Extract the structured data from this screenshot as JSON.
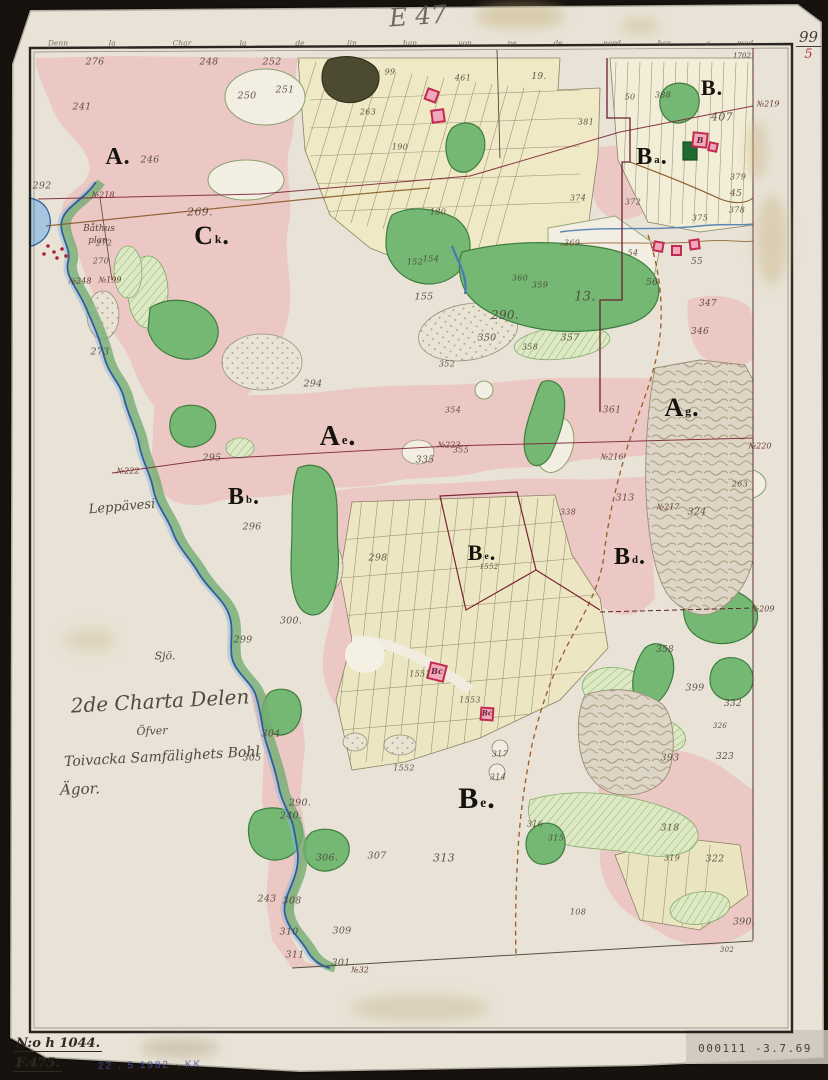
{
  "header": {
    "sheet_code": "E 47",
    "page_number_top": "99",
    "page_number_bottom": "5"
  },
  "archive": {
    "number": "N:o h 1044.",
    "code": "F.475.",
    "stamp_blue": "22 . 5 1982 · KK",
    "stamp_bottom_right": "000111  -3.7.69"
  },
  "margin_words": [
    {
      "t": "Denn",
      "x": 58
    },
    {
      "t": "Ja",
      "x": 112
    },
    {
      "t": "Char",
      "x": 182
    },
    {
      "t": "la",
      "x": 243
    },
    {
      "t": "de",
      "x": 300
    },
    {
      "t": "lin",
      "x": 352
    },
    {
      "t": "han",
      "x": 410
    },
    {
      "t": "von",
      "x": 465
    },
    {
      "t": "ne",
      "x": 512
    },
    {
      "t": "de",
      "x": 558
    },
    {
      "t": "nord",
      "x": 612
    },
    {
      "t": "har",
      "x": 664
    },
    {
      "t": "a",
      "x": 708
    },
    {
      "t": "med",
      "x": 745
    }
  ],
  "colors": {
    "paper": "#e8e3d6",
    "pink_wash": "#ebc8c3",
    "meadow_green": "#74b874",
    "field_yellow": "#efe9c6",
    "water_blue": "#2d5f9e",
    "boundary_red": "#7d2336",
    "marsh": "#ddd5c5",
    "building_red": "#c22a4e",
    "stamp_blue": "#4953ae"
  },
  "map": {
    "section_letters": [
      {
        "n": "section-a",
        "t": "A",
        "d": 1,
        "x": 118,
        "y": 157,
        "fs": 24
      },
      {
        "n": "section-ck",
        "t": "C",
        "s": "k",
        "d": 1,
        "x": 212,
        "y": 236,
        "fs": 26
      },
      {
        "n": "section-b",
        "t": "B",
        "d": 1,
        "x": 712,
        "y": 88,
        "fs": 22
      },
      {
        "n": "section-ba",
        "t": "B",
        "s": "a",
        "d": 1,
        "x": 652,
        "y": 157,
        "fs": 24
      },
      {
        "n": "section-ae-west",
        "t": "A",
        "s": "e",
        "d": 1,
        "x": 338,
        "y": 437,
        "fs": 28
      },
      {
        "n": "section-ag-east",
        "t": "A",
        "s": "g",
        "d": 1,
        "x": 682,
        "y": 408,
        "fs": 26
      },
      {
        "n": "section-bb",
        "t": "B",
        "s": "b",
        "d": 1,
        "x": 244,
        "y": 497,
        "fs": 24
      },
      {
        "n": "section-be-village",
        "t": "B",
        "s": "e",
        "d": 1,
        "x": 482,
        "y": 553,
        "fs": 22
      },
      {
        "n": "section-bd",
        "t": "B",
        "s": "d",
        "d": 1,
        "x": 630,
        "y": 557,
        "fs": 24
      },
      {
        "n": "section-be-south",
        "t": "B",
        "s": "e",
        "d": 1,
        "x": 477,
        "y": 799,
        "fs": 30
      }
    ],
    "parcel_numbers": [
      {
        "t": "276",
        "x": 95,
        "y": 62
      },
      {
        "t": "248",
        "x": 209,
        "y": 62
      },
      {
        "t": "252",
        "x": 272,
        "y": 62
      },
      {
        "t": "251",
        "x": 285,
        "y": 90
      },
      {
        "t": "250",
        "x": 247,
        "y": 96
      },
      {
        "t": "241",
        "x": 82,
        "y": 107
      },
      {
        "t": "246",
        "x": 150,
        "y": 160
      },
      {
        "t": "292",
        "x": 42,
        "y": 186
      },
      {
        "t": "269.",
        "x": 200,
        "y": 212,
        "fs": 11
      },
      {
        "t": "272",
        "x": 104,
        "y": 243,
        "fs": 8
      },
      {
        "t": "270",
        "x": 101,
        "y": 261,
        "fs": 8
      },
      {
        "t": "273",
        "x": 100,
        "y": 352
      },
      {
        "t": "295",
        "x": 212,
        "y": 458
      },
      {
        "t": "294",
        "x": 313,
        "y": 384
      },
      {
        "t": "296",
        "x": 252,
        "y": 527
      },
      {
        "t": "299",
        "x": 243,
        "y": 640
      },
      {
        "t": "300.",
        "x": 291,
        "y": 621
      },
      {
        "t": "304",
        "x": 271,
        "y": 734
      },
      {
        "t": "305",
        "x": 252,
        "y": 758
      },
      {
        "t": "290.",
        "x": 300,
        "y": 803
      },
      {
        "t": "240.",
        "x": 291,
        "y": 816
      },
      {
        "t": "243",
        "x": 267,
        "y": 899
      },
      {
        "t": "306.",
        "x": 327,
        "y": 858
      },
      {
        "t": "307",
        "x": 377,
        "y": 856
      },
      {
        "t": "308",
        "x": 292,
        "y": 901
      },
      {
        "t": "310",
        "x": 289,
        "y": 932
      },
      {
        "t": "309",
        "x": 342,
        "y": 931
      },
      {
        "t": "311",
        "x": 295,
        "y": 955
      },
      {
        "t": "301",
        "x": 341,
        "y": 963
      },
      {
        "t": "313",
        "x": 444,
        "y": 858,
        "fs": 11
      },
      {
        "t": "99",
        "x": 390,
        "y": 72,
        "fs": 8
      },
      {
        "t": "461",
        "x": 463,
        "y": 78,
        "fs": 8
      },
      {
        "t": "263",
        "x": 368,
        "y": 112,
        "fs": 8
      },
      {
        "t": "190",
        "x": 400,
        "y": 147,
        "fs": 8
      },
      {
        "t": "180",
        "x": 438,
        "y": 212,
        "fs": 8
      },
      {
        "t": "152",
        "x": 415,
        "y": 262,
        "fs": 8
      },
      {
        "t": "19.",
        "x": 539,
        "y": 77,
        "fs": 9
      },
      {
        "t": "50",
        "x": 630,
        "y": 97,
        "fs": 8
      },
      {
        "t": "388",
        "x": 663,
        "y": 95,
        "fs": 8
      },
      {
        "t": "381",
        "x": 586,
        "y": 122,
        "fs": 8
      },
      {
        "t": "407",
        "x": 722,
        "y": 117,
        "fs": 11
      },
      {
        "t": "379",
        "x": 738,
        "y": 177,
        "fs": 8
      },
      {
        "t": "45",
        "x": 736,
        "y": 194,
        "fs": 9
      },
      {
        "t": "378",
        "x": 737,
        "y": 210,
        "fs": 8
      },
      {
        "t": "374",
        "x": 578,
        "y": 198,
        "fs": 8
      },
      {
        "t": "372",
        "x": 633,
        "y": 202,
        "fs": 8
      },
      {
        "t": "369",
        "x": 572,
        "y": 243,
        "fs": 8
      },
      {
        "t": "375",
        "x": 700,
        "y": 218,
        "fs": 8
      },
      {
        "t": "54",
        "x": 633,
        "y": 253,
        "fs": 8
      },
      {
        "t": "55",
        "x": 697,
        "y": 262,
        "fs": 9
      },
      {
        "t": "56",
        "x": 652,
        "y": 283,
        "fs": 9
      },
      {
        "t": "347",
        "x": 708,
        "y": 304,
        "fs": 9
      },
      {
        "t": "346",
        "x": 700,
        "y": 332,
        "fs": 9
      },
      {
        "t": "154",
        "x": 431,
        "y": 259,
        "fs": 8
      },
      {
        "t": "155",
        "x": 424,
        "y": 297
      },
      {
        "t": "360",
        "x": 520,
        "y": 278,
        "fs": 8
      },
      {
        "t": "359",
        "x": 540,
        "y": 285,
        "fs": 8
      },
      {
        "t": "13.",
        "x": 585,
        "y": 297,
        "fs": 13
      },
      {
        "t": "290.",
        "x": 505,
        "y": 315,
        "fs": 12
      },
      {
        "t": "350",
        "x": 487,
        "y": 338
      },
      {
        "t": "357",
        "x": 570,
        "y": 338
      },
      {
        "t": "358",
        "x": 530,
        "y": 347,
        "fs": 8
      },
      {
        "t": "352",
        "x": 447,
        "y": 364,
        "fs": 8
      },
      {
        "t": "354",
        "x": 453,
        "y": 410,
        "fs": 8
      },
      {
        "t": "355",
        "x": 461,
        "y": 450,
        "fs": 8
      },
      {
        "t": "335",
        "x": 425,
        "y": 460
      },
      {
        "t": "361",
        "x": 612,
        "y": 410
      },
      {
        "t": "313",
        "x": 625,
        "y": 498
      },
      {
        "t": "324",
        "x": 697,
        "y": 512
      },
      {
        "t": "263",
        "x": 740,
        "y": 484,
        "fs": 8
      },
      {
        "t": "338",
        "x": 568,
        "y": 512,
        "fs": 8
      },
      {
        "t": "298",
        "x": 378,
        "y": 558
      },
      {
        "t": "1552",
        "x": 489,
        "y": 567,
        "fs": 7
      },
      {
        "t": "1551",
        "x": 420,
        "y": 674,
        "fs": 8
      },
      {
        "t": "1553",
        "x": 470,
        "y": 700,
        "fs": 8
      },
      {
        "t": "1552",
        "x": 404,
        "y": 768,
        "fs": 8
      },
      {
        "t": "317",
        "x": 500,
        "y": 754,
        "fs": 8
      },
      {
        "t": "314",
        "x": 498,
        "y": 777,
        "fs": 8
      },
      {
        "t": "358",
        "x": 665,
        "y": 650,
        "fs": 9
      },
      {
        "t": "399",
        "x": 695,
        "y": 688
      },
      {
        "t": "332",
        "x": 733,
        "y": 704,
        "fs": 9
      },
      {
        "t": "326",
        "x": 720,
        "y": 726,
        "fs": 7
      },
      {
        "t": "393",
        "x": 670,
        "y": 758
      },
      {
        "t": "323",
        "x": 725,
        "y": 757,
        "fs": 9
      },
      {
        "t": "316",
        "x": 535,
        "y": 824,
        "fs": 8
      },
      {
        "t": "315",
        "x": 556,
        "y": 838,
        "fs": 8
      },
      {
        "t": "318",
        "x": 670,
        "y": 828
      },
      {
        "t": "319",
        "x": 672,
        "y": 858,
        "fs": 8
      },
      {
        "t": "322",
        "x": 715,
        "y": 859
      },
      {
        "t": "390.",
        "x": 744,
        "y": 922
      },
      {
        "t": "108",
        "x": 578,
        "y": 912,
        "fs": 8
      },
      {
        "t": "302",
        "x": 727,
        "y": 950,
        "fs": 7
      }
    ],
    "survey_markers": [
      {
        "t": "№218",
        "x": 103,
        "y": 195
      },
      {
        "t": "№219",
        "x": 768,
        "y": 104
      },
      {
        "t": "№222",
        "x": 128,
        "y": 471
      },
      {
        "t": "№223",
        "x": 449,
        "y": 445
      },
      {
        "t": "№220",
        "x": 760,
        "y": 446
      },
      {
        "t": "№216",
        "x": 612,
        "y": 457
      },
      {
        "t": "№217",
        "x": 668,
        "y": 507
      },
      {
        "t": "№209",
        "x": 763,
        "y": 609
      },
      {
        "t": "№248",
        "x": 80,
        "y": 281
      },
      {
        "t": "№199",
        "x": 110,
        "y": 280
      },
      {
        "t": "№32",
        "x": 360,
        "y": 970
      }
    ],
    "place_labels": [
      {
        "n": "sheet-code",
        "t": "E 47",
        "x": 418,
        "y": 16,
        "fs": 25,
        "rot": -4,
        "c": "pencil"
      },
      {
        "n": "map-title-line1",
        "t": "2de Charta Delen",
        "x": 160,
        "y": 701,
        "fs": 20,
        "rot": -3,
        "c": "script"
      },
      {
        "n": "map-title-line2",
        "t": "Öfver",
        "x": 152,
        "y": 731,
        "fs": 11,
        "rot": -2,
        "c": "script"
      },
      {
        "n": "map-title-line3",
        "t": "Toivacka Samfälighets Bohl",
        "x": 162,
        "y": 757,
        "fs": 14,
        "rot": -3,
        "c": "script"
      },
      {
        "n": "map-title-line4",
        "t": "Ägor.",
        "x": 80,
        "y": 789,
        "fs": 15,
        "rot": -2,
        "c": "script"
      },
      {
        "n": "boathouse-label-1",
        "t": "Båthus",
        "x": 99,
        "y": 229,
        "fs": 9,
        "c": "script2"
      },
      {
        "n": "boathouse-label-2",
        "t": "plan",
        "x": 98,
        "y": 241,
        "fs": 9,
        "c": "script2"
      },
      {
        "n": "lake-name",
        "t": "Leppävesi",
        "x": 122,
        "y": 507,
        "fs": 13,
        "rot": -5,
        "c": "script"
      },
      {
        "n": "lake-word",
        "t": "Sjö.",
        "x": 165,
        "y": 656,
        "fs": 11,
        "c": "script"
      },
      {
        "n": "margin-note",
        "t": "1702",
        "x": 742,
        "y": 56,
        "fs": 7
      }
    ],
    "building_labels": [
      {
        "n": "farmstead-letter",
        "t": "B",
        "x": 700,
        "y": 140,
        "fs": 8
      },
      {
        "n": "farmstead-letter",
        "t": "B",
        "s": "c",
        "x": 437,
        "y": 671,
        "fs": 8
      },
      {
        "n": "farmstead-letter",
        "t": "B",
        "s": "c",
        "x": 487,
        "y": 713,
        "fs": 7
      }
    ]
  }
}
